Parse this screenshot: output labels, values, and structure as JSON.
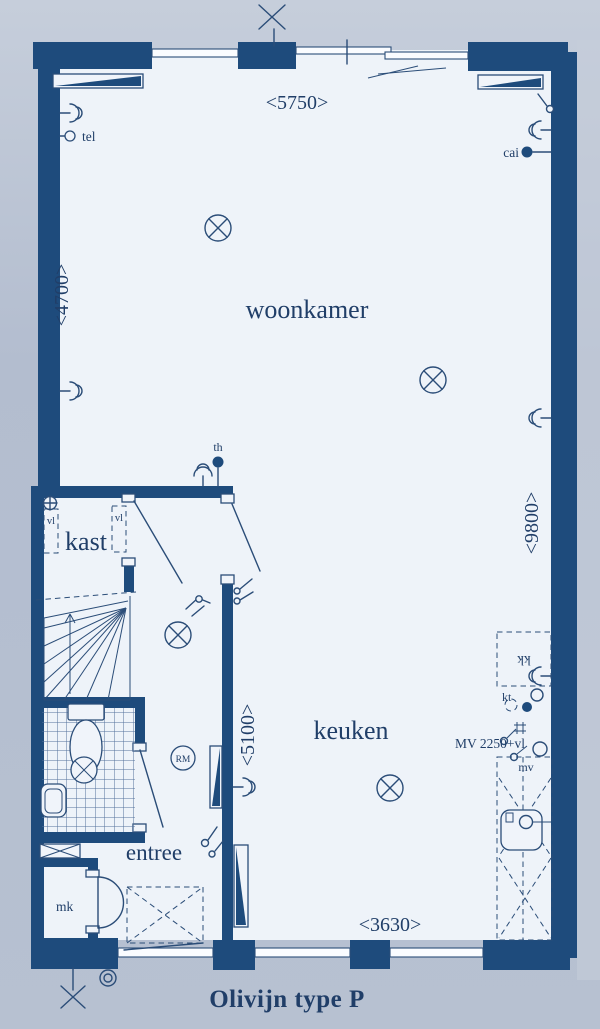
{
  "title": "Olivijn type P",
  "rooms": {
    "woonkamer": "woonkamer",
    "kast": "kast",
    "keuken": "keuken",
    "entree": "entree",
    "meterkast": "mk"
  },
  "dimensions": {
    "top": "<5750>",
    "left": "<4700>",
    "right": "<9800>",
    "middle": "<5100>",
    "bottom": "<3630>"
  },
  "labels": {
    "tel": "tel",
    "cai": "cai",
    "th": "th",
    "rm": "RM",
    "vl": "vl",
    "kk": "kk",
    "kt": "kt",
    "mv": "mv",
    "mv_height": "MV 2250+vl"
  },
  "colors": {
    "wall": "#1e4b7c",
    "ink": "#2b4d78",
    "paper": "#eef3f9",
    "background": "#b5bfd0",
    "text": "#203e68"
  }
}
